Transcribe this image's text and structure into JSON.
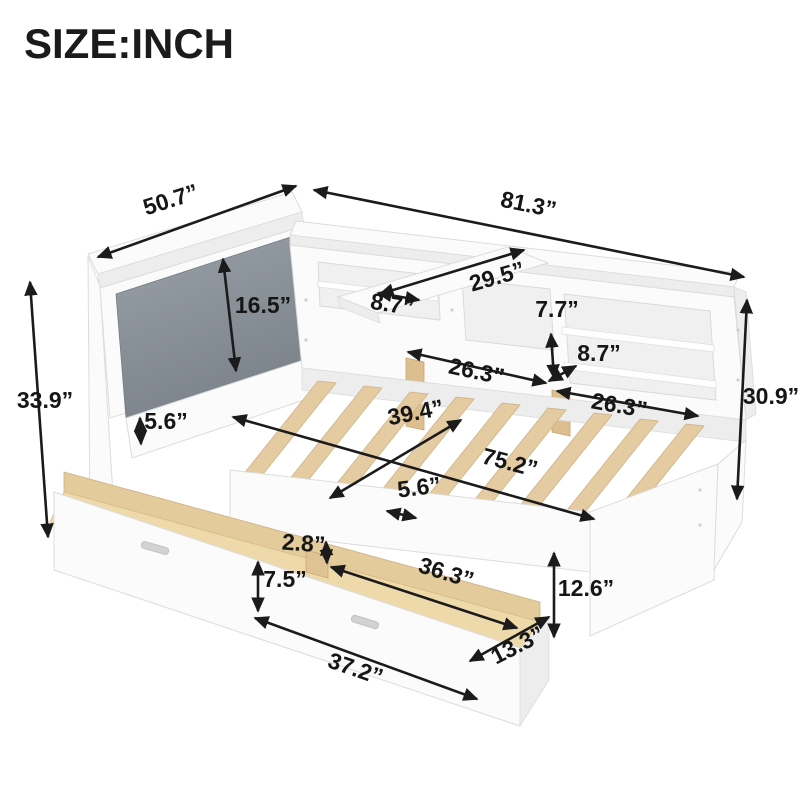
{
  "title": "SIZE:INCH",
  "unit": "INCH",
  "colors": {
    "background": "#ffffff",
    "arrow": "#1b1b1b",
    "label_text": "#161616",
    "frame_white": "#fbfbfb",
    "frame_shadow": "#ededed",
    "cushion_gray_light": "#9aa1a9",
    "cushion_gray_dark": "#7b828a",
    "slat_wood": "#e5cba1",
    "drawer_wood": "#eed9ab"
  },
  "dimensions": {
    "headboard_width": {
      "label": "50.7”"
    },
    "overall_length": {
      "label": "81.3”"
    },
    "tray_shelf_length": {
      "label": "29.5”"
    },
    "tray_shelf_depth": {
      "label": "8.7”"
    },
    "cushion_height": {
      "label": "16.5”"
    },
    "upper_shelf_opening_height": {
      "label": "7.7”"
    },
    "shelf_opening_height": {
      "label": "8.7”"
    },
    "left_shelf_width": {
      "label": "26.3”"
    },
    "right_shelf_width": {
      "label": "26.3”"
    },
    "overall_height": {
      "label": "33.9”"
    },
    "bookcase_height": {
      "label": "30.9”"
    },
    "under_cushion_gap": {
      "label": "5.6”"
    },
    "slat_width": {
      "label": "39.4”"
    },
    "sleep_length": {
      "label": "75.2”"
    },
    "slat_spacing": {
      "label": "5.6”"
    },
    "divider_height": {
      "label": "2.8”"
    },
    "drawer_inner_length": {
      "label": "36.3”"
    },
    "drawer_front_height": {
      "label": "7.5”"
    },
    "side_rail_height": {
      "label": "12.6”"
    },
    "drawer_front_length": {
      "label": "37.2”"
    },
    "drawer_side_depth": {
      "label": "13.3”"
    }
  }
}
